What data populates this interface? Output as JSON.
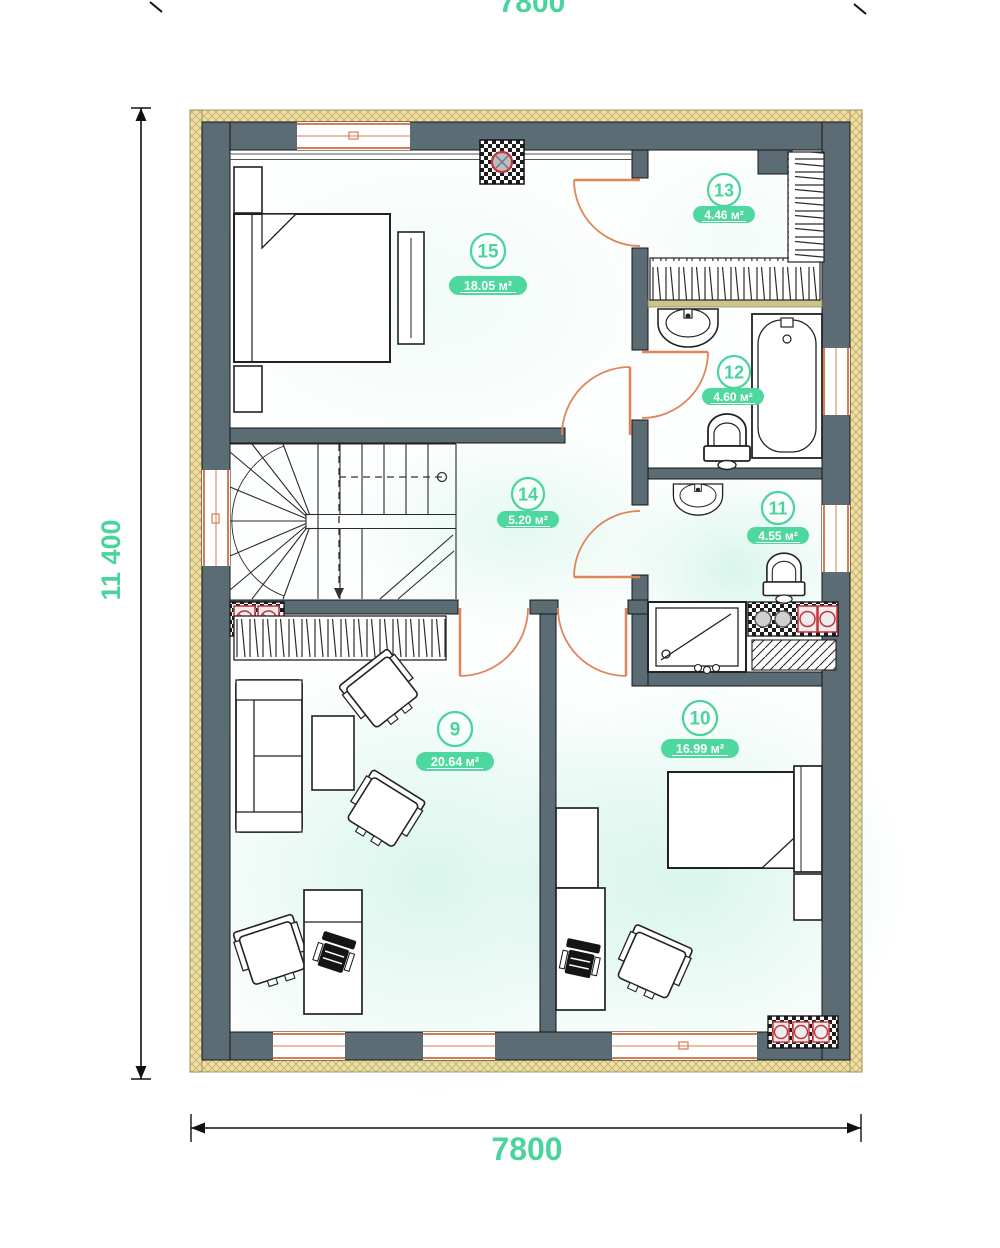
{
  "plan": {
    "dimensions": {
      "width_top": "7800",
      "height_left": "11 400",
      "width_bottom": "7800"
    },
    "rooms": [
      {
        "number": "9",
        "area": "20.64 м²",
        "fixtures": [
          "sofa",
          "coffee-table",
          "armchairs",
          "desk",
          "office-chair",
          "wardrobe"
        ]
      },
      {
        "number": "10",
        "area": "16.99 м²",
        "fixtures": [
          "single-bed",
          "nightstand",
          "desk",
          "office-chair",
          "armchair"
        ]
      },
      {
        "number": "11",
        "area": "4.55 м²",
        "fixtures": [
          "sink",
          "toilet",
          "shower"
        ]
      },
      {
        "number": "12",
        "area": "4.60 м²",
        "fixtures": [
          "sink",
          "bathtub",
          "toilet"
        ]
      },
      {
        "number": "13",
        "area": "4.46 м²",
        "fixtures": [
          "wardrobe"
        ]
      },
      {
        "number": "14",
        "area": "5.20 м²",
        "fixtures": []
      },
      {
        "number": "15",
        "area": "18.05 м²",
        "fixtures": [
          "double-bed",
          "nightstands",
          "dresser"
        ]
      }
    ],
    "colors": {
      "accent_green": "#49d49d",
      "wall": "#5c6c74",
      "insulation": "#ecdfa6",
      "window_frame": "#d97b4f",
      "door": "#e0855a",
      "vent_red": "#c8303a"
    }
  }
}
